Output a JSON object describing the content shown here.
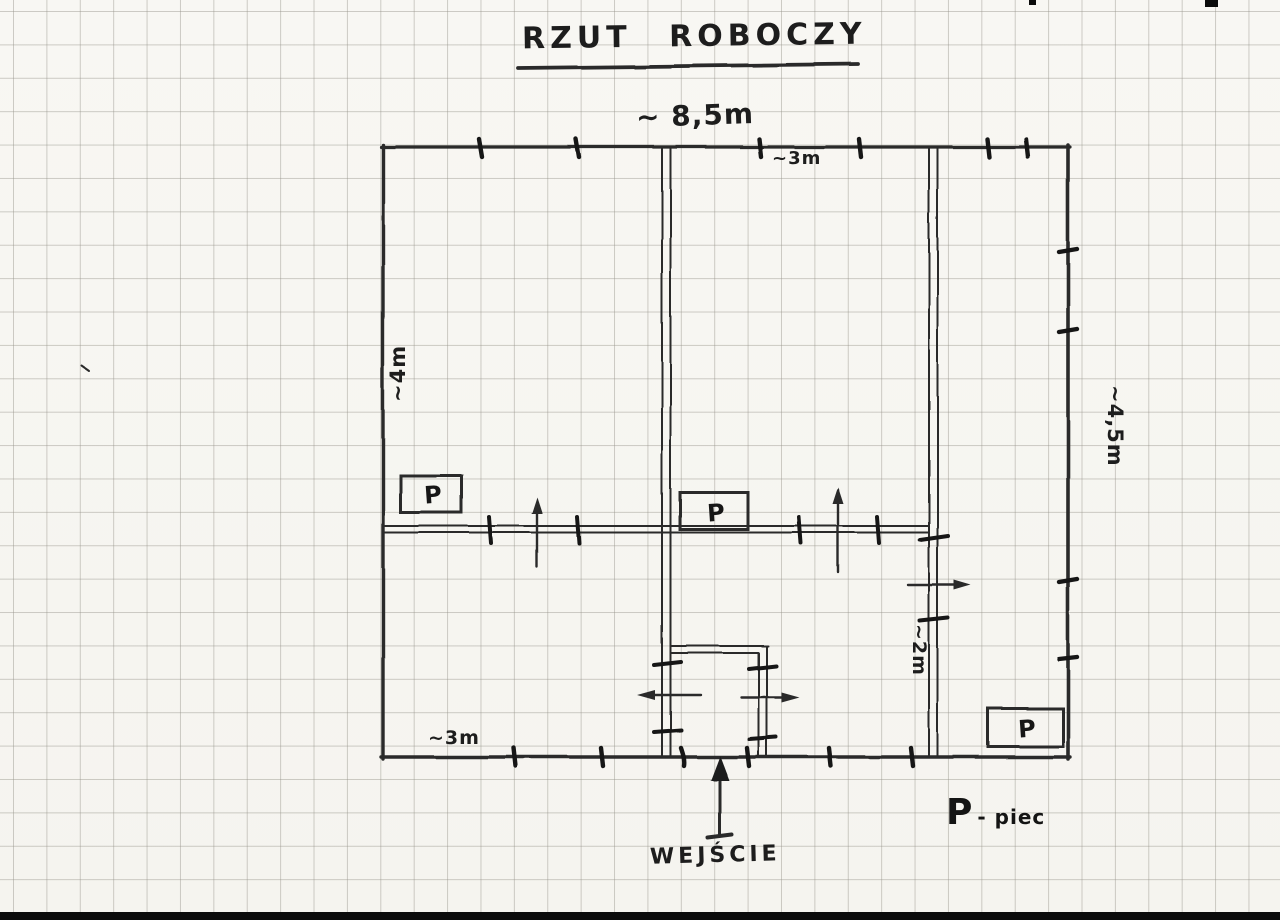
{
  "labels": {
    "title": "RZUT ROBOCZY",
    "entrance": "WEJŚCIE"
  },
  "dimensions": {
    "top_overall": "~ 8,5m",
    "top_right_section": "~3m",
    "left_room_height": "~4m",
    "right_height": "~4,5m",
    "hallway_width": "~2m",
    "bottom_left_section": "~3m"
  },
  "stoves": [
    "P",
    "P",
    "P"
  ],
  "legend": {
    "symbol": "P",
    "meaning": "- piec"
  },
  "colors": {
    "ink": "#2a2a2a",
    "tick_ink": "#161616",
    "paper": "#f7f6f2",
    "grid": "#96938a"
  }
}
